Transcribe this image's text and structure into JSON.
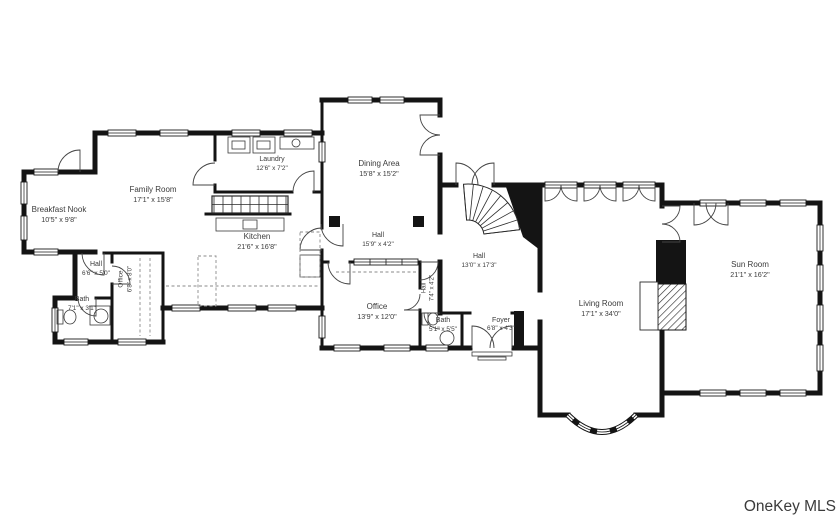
{
  "plan": {
    "rooms": {
      "breakfast_nook": {
        "name": "Breakfast Nook",
        "dims": "10'5\" x 9'8\""
      },
      "family_room": {
        "name": "Family Room",
        "dims": "17'1\" x 15'8\""
      },
      "laundry": {
        "name": "Laundry",
        "dims": "12'6\" x 7'2\""
      },
      "kitchen": {
        "name": "Kitchen",
        "dims": "21'6\" x 16'8\""
      },
      "dining_area": {
        "name": "Dining Area",
        "dims": "15'8\" x 15'2\""
      },
      "hall_center": {
        "name": "Hall",
        "dims": "15'9\" x 4'2\""
      },
      "hall_west": {
        "name": "Hall",
        "dims": "6'6\" x 5'0\""
      },
      "office_west": {
        "name": "Office",
        "dims": "6'8\" x 8'0\""
      },
      "bath_west": {
        "name": "Bath",
        "dims": "7'1\" x 3'1\""
      },
      "office_center": {
        "name": "Office",
        "dims": "13'9\" x 12'0\""
      },
      "hall_mid": {
        "name": "Hall",
        "dims": "7'4\" x 4'2\""
      },
      "bath_center": {
        "name": "Bath",
        "dims": "5'1\" x 5'5\""
      },
      "foyer": {
        "name": "Foyer",
        "dims": "6'8\" x 4'3\""
      },
      "hall_stair": {
        "name": "Hall",
        "dims": "13'0\" x 17'3\""
      },
      "living_room": {
        "name": "Living Room",
        "dims": "17'1\" x 34'0\""
      },
      "sun_room": {
        "name": "Sun Room",
        "dims": "21'1\" x 16'2\""
      }
    },
    "watermark": "OneKey MLS",
    "colors": {
      "wall": "#141414",
      "label": "#3b3b3b",
      "watermark": "#aeb2b6"
    }
  }
}
